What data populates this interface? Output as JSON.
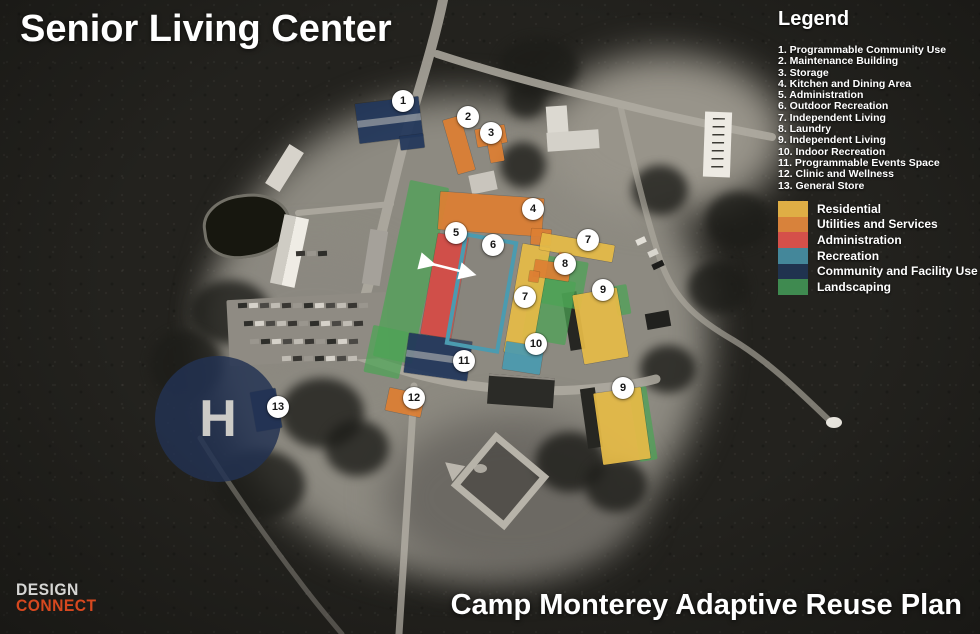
{
  "title": "Senior Living Center",
  "subtitle": "Camp Monterey Adaptive Reuse Plan",
  "logo": {
    "line1": "DESIGN",
    "line2": "CONNECT"
  },
  "legend": {
    "title": "Legend",
    "items": [
      "1. Programmable Community Use",
      "2. Maintenance Building",
      "3. Storage",
      "4. Kitchen and Dining Area",
      "5. Administration",
      "6. Outdoor Recreation",
      "7. Independent Living",
      "8. Laundry",
      "9. Independent Living",
      "10. Indoor Recreation",
      "11. Programmable Events Space",
      "12. Clinic and Wellness",
      "13. General Store"
    ],
    "categories": [
      {
        "label": "Residential",
        "color": "#DFAE45"
      },
      {
        "label": "Utilities and Services",
        "color": "#D8823B"
      },
      {
        "label": "Administration",
        "color": "#D5504A"
      },
      {
        "label": "Recreation",
        "color": "#44879A"
      },
      {
        "label": "Community and Facility Use",
        "color": "#20334F"
      },
      {
        "label": "Landscaping",
        "color": "#3F8A50"
      }
    ]
  },
  "colors": {
    "residential": "#E6BB47",
    "utilities": "#DD7F33",
    "admin": "#D64B45",
    "recreation": "#4B9BB0",
    "community": "#22375B",
    "landscaping": "#4CA355"
  },
  "map": {
    "helipad": {
      "letter": "H",
      "x": 218,
      "y": 419,
      "d": 126
    },
    "markers": [
      {
        "num": "1",
        "x": 403,
        "y": 101
      },
      {
        "num": "2",
        "x": 468,
        "y": 117
      },
      {
        "num": "3",
        "x": 491,
        "y": 133
      },
      {
        "num": "4",
        "x": 533,
        "y": 209
      },
      {
        "num": "5",
        "x": 456,
        "y": 233
      },
      {
        "num": "6",
        "x": 493,
        "y": 245
      },
      {
        "num": "7",
        "x": 588,
        "y": 240
      },
      {
        "num": "8",
        "x": 565,
        "y": 264
      },
      {
        "num": "7",
        "x": 525,
        "y": 297
      },
      {
        "num": "9",
        "x": 603,
        "y": 290
      },
      {
        "num": "10",
        "x": 536,
        "y": 344
      },
      {
        "num": "11",
        "x": 464,
        "y": 361
      },
      {
        "num": "12",
        "x": 414,
        "y": 398
      },
      {
        "num": "9",
        "x": 623,
        "y": 388
      },
      {
        "num": "13",
        "x": 278,
        "y": 407
      }
    ],
    "overlays": [
      {
        "name": "building-1-community-use",
        "category": "community",
        "x": 389,
        "y": 120,
        "w": 64,
        "h": 40,
        "r": -7,
        "stripe": true
      },
      {
        "name": "building-1-wing",
        "category": "community",
        "x": 412,
        "y": 142,
        "w": 24,
        "h": 14,
        "r": -7
      },
      {
        "name": "building-2-maintenance",
        "category": "utilities",
        "x": 459,
        "y": 145,
        "w": 18,
        "h": 56,
        "r": -16
      },
      {
        "name": "building-3-storage-a",
        "category": "utilities",
        "x": 491,
        "y": 136,
        "w": 30,
        "h": 18,
        "r": -10
      },
      {
        "name": "building-3-storage-b",
        "category": "utilities",
        "x": 496,
        "y": 152,
        "w": 14,
        "h": 20,
        "r": -10
      },
      {
        "name": "building-4-kitchen-dining",
        "category": "utilities",
        "x": 491,
        "y": 214,
        "w": 104,
        "h": 38,
        "r": 4
      },
      {
        "name": "building-4-wing",
        "category": "utilities",
        "x": 541,
        "y": 237,
        "w": 20,
        "h": 16,
        "r": 4
      },
      {
        "name": "building-5-administration",
        "category": "admin",
        "x": 444,
        "y": 286,
        "w": 31,
        "h": 102,
        "r": 10
      },
      {
        "name": "building-7-independent-living-mid",
        "category": "residential",
        "x": 527,
        "y": 300,
        "w": 28,
        "h": 110,
        "r": 10
      },
      {
        "name": "building-7-independent-living-top",
        "category": "residential",
        "x": 577,
        "y": 247,
        "w": 74,
        "h": 17,
        "r": 10
      },
      {
        "name": "building-8-laundry",
        "category": "utilities",
        "x": 552,
        "y": 270,
        "w": 36,
        "h": 17,
        "r": 9
      },
      {
        "name": "building-8-laundry-b",
        "category": "utilities",
        "x": 564,
        "y": 259,
        "w": 13,
        "h": 13,
        "r": 9
      },
      {
        "name": "building-8-laundry-c",
        "category": "utilities",
        "x": 534,
        "y": 276,
        "w": 10,
        "h": 11,
        "r": 9
      },
      {
        "name": "building-9-independent-living-top",
        "category": "residential",
        "x": 600,
        "y": 326,
        "w": 45,
        "h": 70,
        "r": -10
      },
      {
        "name": "building-9-independent-living-bottom",
        "category": "residential",
        "x": 622,
        "y": 426,
        "w": 48,
        "h": 72,
        "r": -8
      },
      {
        "name": "building-10-indoor-recreation",
        "category": "recreation",
        "x": 523,
        "y": 358,
        "w": 38,
        "h": 28,
        "r": 9
      },
      {
        "name": "building-11-events-space",
        "category": "community",
        "x": 438,
        "y": 357,
        "w": 64,
        "h": 40,
        "r": 8,
        "stripe": true
      },
      {
        "name": "building-12-clinic-wellness",
        "category": "utilities",
        "x": 405,
        "y": 402,
        "w": 36,
        "h": 23,
        "r": 12
      },
      {
        "name": "building-13-general-store",
        "category": "community",
        "x": 266,
        "y": 410,
        "w": 26,
        "h": 40,
        "r": -10
      }
    ],
    "landscaping": [
      {
        "x": 411,
        "y": 272,
        "w": 40,
        "h": 180,
        "r": 12
      },
      {
        "x": 386,
        "y": 352,
        "w": 36,
        "h": 48,
        "r": 12
      },
      {
        "x": 560,
        "y": 282,
        "w": 50,
        "h": 48,
        "r": 10
      },
      {
        "x": 549,
        "y": 310,
        "w": 44,
        "h": 64,
        "r": 10
      },
      {
        "x": 622,
        "y": 300,
        "w": 14,
        "h": 30,
        "r": -10
      },
      {
        "x": 643,
        "y": 424,
        "w": 18,
        "h": 74,
        "r": -9
      }
    ],
    "courtyard": {
      "x": 481,
      "y": 293,
      "w": 47,
      "h": 106,
      "r": 10
    }
  }
}
